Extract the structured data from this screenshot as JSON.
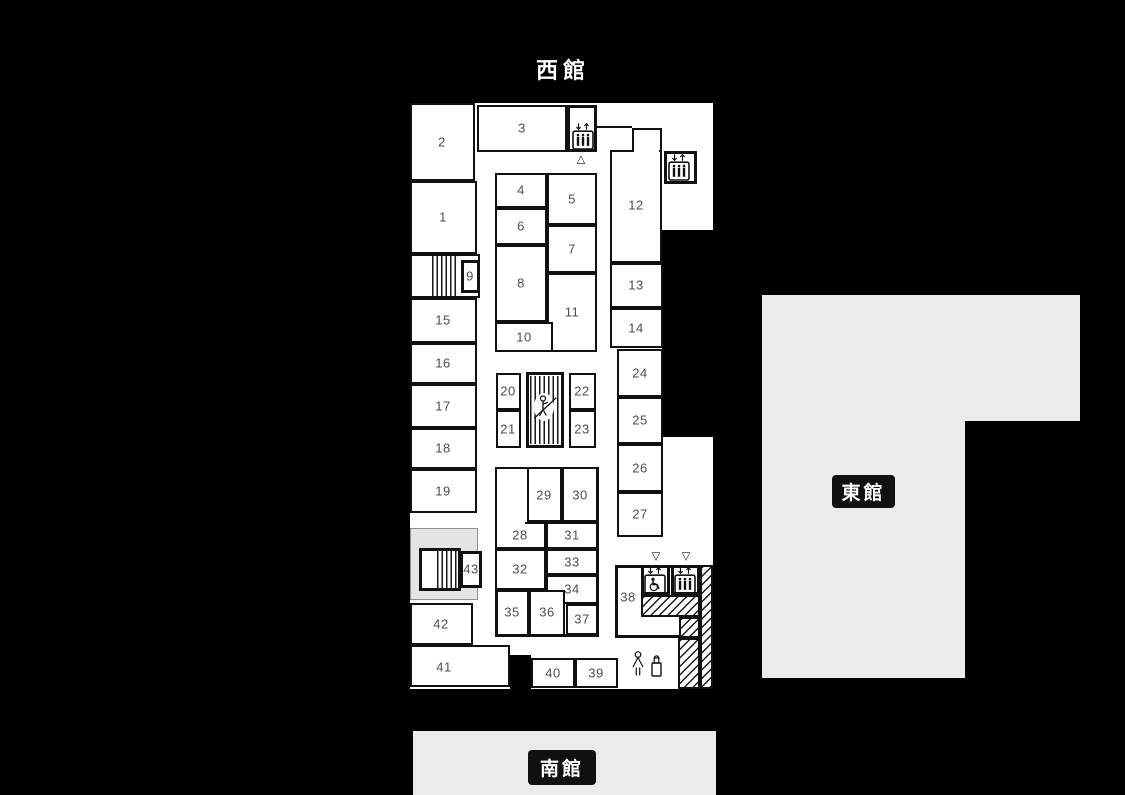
{
  "buildings": {
    "west": {
      "title": "西館"
    },
    "east": {
      "label": "東館"
    },
    "south": {
      "label": "南館"
    }
  },
  "palette": {
    "background": "#000000",
    "wall": "#111111",
    "room_fill": "#ffffff",
    "number_color": "#4d4d4d",
    "building_gray": "#ebebeb",
    "badge_bg": "#111111",
    "badge_text": "#ffffff"
  },
  "floorplan": {
    "base": {
      "x": 410,
      "y": 103,
      "w": 303,
      "h": 586
    },
    "boxes": [
      {
        "name": "room-2",
        "x": 410,
        "y": 103,
        "w": 65,
        "h": 78,
        "b": 2
      },
      {
        "name": "room-1",
        "x": 410,
        "y": 181,
        "w": 67,
        "h": 73,
        "b": 2
      },
      {
        "name": "stairs-box-north",
        "x": 410,
        "y": 254,
        "w": 70,
        "h": 44,
        "b": 2
      },
      {
        "name": "room-9",
        "x": 461,
        "y": 260,
        "w": 19,
        "h": 33,
        "b": 3
      },
      {
        "name": "room-15",
        "x": 410,
        "y": 298,
        "w": 67,
        "h": 45,
        "b": 2
      },
      {
        "name": "room-16",
        "x": 410,
        "y": 343,
        "w": 67,
        "h": 41,
        "b": 2
      },
      {
        "name": "room-17",
        "x": 410,
        "y": 384,
        "w": 67,
        "h": 44,
        "b": 2
      },
      {
        "name": "room-18",
        "x": 410,
        "y": 428,
        "w": 67,
        "h": 41,
        "b": 2
      },
      {
        "name": "room-19",
        "x": 410,
        "y": 469,
        "w": 67,
        "h": 44,
        "b": 2
      },
      {
        "name": "stairs-box-south",
        "x": 419,
        "y": 548,
        "w": 42,
        "h": 43,
        "b": 3
      },
      {
        "name": "room-43",
        "x": 460,
        "y": 551,
        "w": 22,
        "h": 37,
        "b": 3
      },
      {
        "name": "room-42",
        "x": 410,
        "y": 603,
        "w": 63,
        "h": 42,
        "b": 2
      },
      {
        "name": "room-41",
        "x": 410,
        "y": 645,
        "w": 100,
        "h": 42,
        "b": 2
      },
      {
        "name": "room-3",
        "x": 477,
        "y": 105,
        "w": 90,
        "h": 47,
        "b": 2
      },
      {
        "name": "elevator-box-north",
        "x": 567,
        "y": 105,
        "w": 30,
        "h": 47,
        "b": 3
      },
      {
        "name": "room-12-main",
        "x": 610,
        "y": 150,
        "w": 52,
        "h": 113,
        "b": 2
      },
      {
        "name": "room-12-top",
        "x": 632,
        "y": 128,
        "w": 30,
        "h": 24,
        "b": 2
      },
      {
        "name": "elevator-box-east",
        "x": 664,
        "y": 151,
        "w": 33,
        "h": 33,
        "b": 3
      },
      {
        "name": "room-13",
        "x": 610,
        "y": 263,
        "w": 53,
        "h": 45,
        "b": 2
      },
      {
        "name": "room-14",
        "x": 610,
        "y": 308,
        "w": 53,
        "h": 40,
        "b": 2
      },
      {
        "name": "block-4-11",
        "x": 495,
        "y": 173,
        "w": 102,
        "h": 179,
        "b": 3
      },
      {
        "name": "room-4",
        "x": 495,
        "y": 173,
        "w": 52,
        "h": 35,
        "b": 2
      },
      {
        "name": "room-5",
        "x": 547,
        "y": 173,
        "w": 50,
        "h": 52,
        "b": 2
      },
      {
        "name": "room-6",
        "x": 495,
        "y": 208,
        "w": 52,
        "h": 37,
        "b": 2
      },
      {
        "name": "room-7",
        "x": 547,
        "y": 225,
        "w": 50,
        "h": 48,
        "b": 2
      },
      {
        "name": "room-8",
        "x": 495,
        "y": 245,
        "w": 52,
        "h": 77,
        "b": 2
      },
      {
        "name": "room-11",
        "x": 547,
        "y": 273,
        "w": 50,
        "h": 79,
        "b": 2
      },
      {
        "name": "room-10",
        "x": 495,
        "y": 322,
        "w": 58,
        "h": 30,
        "b": 2
      },
      {
        "name": "block-20-21",
        "x": 496,
        "y": 373,
        "w": 25,
        "h": 75,
        "b": 3
      },
      {
        "name": "room-20",
        "x": 496,
        "y": 373,
        "w": 25,
        "h": 37,
        "b": 2
      },
      {
        "name": "room-21",
        "x": 496,
        "y": 410,
        "w": 25,
        "h": 38,
        "b": 2
      },
      {
        "name": "escalator-box",
        "x": 526,
        "y": 372,
        "w": 38,
        "h": 76,
        "b": 3
      },
      {
        "name": "block-22-23",
        "x": 569,
        "y": 373,
        "w": 27,
        "h": 75,
        "b": 3
      },
      {
        "name": "room-22",
        "x": 569,
        "y": 373,
        "w": 27,
        "h": 37,
        "b": 2
      },
      {
        "name": "room-23",
        "x": 569,
        "y": 410,
        "w": 27,
        "h": 38,
        "b": 2
      },
      {
        "name": "room-24",
        "x": 617,
        "y": 349,
        "w": 46,
        "h": 48,
        "b": 2
      },
      {
        "name": "room-25",
        "x": 617,
        "y": 397,
        "w": 46,
        "h": 47,
        "b": 2
      },
      {
        "name": "room-26",
        "x": 617,
        "y": 444,
        "w": 46,
        "h": 48,
        "b": 2
      },
      {
        "name": "room-27",
        "x": 617,
        "y": 492,
        "w": 46,
        "h": 45,
        "b": 2
      },
      {
        "name": "block-28-37",
        "x": 495,
        "y": 467,
        "w": 104,
        "h": 170,
        "b": 3
      },
      {
        "name": "room-28-upper",
        "x": 495,
        "y": 467,
        "w": 34,
        "h": 57,
        "b": 2
      },
      {
        "name": "room-29",
        "x": 527,
        "y": 467,
        "w": 35,
        "h": 55,
        "b": 2
      },
      {
        "name": "room-30",
        "x": 562,
        "y": 467,
        "w": 36,
        "h": 55,
        "b": 2
      },
      {
        "name": "room-28",
        "x": 495,
        "y": 522,
        "w": 51,
        "h": 27,
        "b": 2
      },
      {
        "name": "room-31",
        "x": 546,
        "y": 522,
        "w": 52,
        "h": 27,
        "b": 2
      },
      {
        "name": "room-32",
        "x": 495,
        "y": 549,
        "w": 51,
        "h": 41,
        "b": 2
      },
      {
        "name": "room-33",
        "x": 546,
        "y": 549,
        "w": 52,
        "h": 26,
        "b": 2
      },
      {
        "name": "room-34",
        "x": 546,
        "y": 575,
        "w": 52,
        "h": 29,
        "b": 2
      },
      {
        "name": "block-35-36",
        "x": 496,
        "y": 590,
        "w": 69,
        "h": 46,
        "b": 3
      },
      {
        "name": "room-35",
        "x": 496,
        "y": 590,
        "w": 33,
        "h": 46,
        "b": 2
      },
      {
        "name": "room-36",
        "x": 529,
        "y": 590,
        "w": 36,
        "h": 46,
        "b": 2
      },
      {
        "name": "room-37",
        "x": 566,
        "y": 604,
        "w": 32,
        "h": 31,
        "b": 2
      },
      {
        "name": "block-38",
        "x": 615,
        "y": 565,
        "w": 86,
        "h": 73,
        "b": 3
      },
      {
        "name": "elevator-box-wheelchair",
        "x": 641,
        "y": 565,
        "w": 29,
        "h": 30,
        "b": 3
      },
      {
        "name": "elevator-box-south",
        "x": 671,
        "y": 565,
        "w": 29,
        "h": 30,
        "b": 3
      },
      {
        "name": "room-40",
        "x": 531,
        "y": 658,
        "w": 44,
        "h": 30,
        "b": 2
      },
      {
        "name": "room-39",
        "x": 575,
        "y": 658,
        "w": 43,
        "h": 30,
        "b": 2
      }
    ],
    "labels": [
      {
        "t": "1",
        "x": 443,
        "y": 217
      },
      {
        "t": "2",
        "x": 442,
        "y": 142
      },
      {
        "t": "3",
        "x": 522,
        "y": 128
      },
      {
        "t": "4",
        "x": 521,
        "y": 190
      },
      {
        "t": "5",
        "x": 572,
        "y": 199
      },
      {
        "t": "6",
        "x": 521,
        "y": 226
      },
      {
        "t": "7",
        "x": 572,
        "y": 249
      },
      {
        "t": "8",
        "x": 521,
        "y": 283
      },
      {
        "t": "9",
        "x": 470,
        "y": 276
      },
      {
        "t": "10",
        "x": 524,
        "y": 337
      },
      {
        "t": "11",
        "x": 572,
        "y": 312
      },
      {
        "t": "12",
        "x": 636,
        "y": 205
      },
      {
        "t": "13",
        "x": 636,
        "y": 285
      },
      {
        "t": "14",
        "x": 636,
        "y": 328
      },
      {
        "t": "15",
        "x": 443,
        "y": 320
      },
      {
        "t": "16",
        "x": 443,
        "y": 363
      },
      {
        "t": "17",
        "x": 443,
        "y": 406
      },
      {
        "t": "18",
        "x": 443,
        "y": 448
      },
      {
        "t": "19",
        "x": 443,
        "y": 491
      },
      {
        "t": "20",
        "x": 508,
        "y": 391
      },
      {
        "t": "21",
        "x": 508,
        "y": 429
      },
      {
        "t": "22",
        "x": 582,
        "y": 391
      },
      {
        "t": "23",
        "x": 582,
        "y": 429
      },
      {
        "t": "24",
        "x": 640,
        "y": 373
      },
      {
        "t": "25",
        "x": 640,
        "y": 420
      },
      {
        "t": "26",
        "x": 640,
        "y": 468
      },
      {
        "t": "27",
        "x": 640,
        "y": 514
      },
      {
        "t": "28",
        "x": 520,
        "y": 535
      },
      {
        "t": "29",
        "x": 544,
        "y": 495
      },
      {
        "t": "30",
        "x": 580,
        "y": 495
      },
      {
        "t": "31",
        "x": 572,
        "y": 535
      },
      {
        "t": "32",
        "x": 520,
        "y": 569
      },
      {
        "t": "33",
        "x": 572,
        "y": 562
      },
      {
        "t": "34",
        "x": 572,
        "y": 589
      },
      {
        "t": "35",
        "x": 512,
        "y": 612
      },
      {
        "t": "36",
        "x": 547,
        "y": 612
      },
      {
        "t": "37",
        "x": 582,
        "y": 619
      },
      {
        "t": "38",
        "x": 628,
        "y": 597
      },
      {
        "t": "39",
        "x": 596,
        "y": 673
      },
      {
        "t": "40",
        "x": 553,
        "y": 673
      },
      {
        "t": "41",
        "x": 444,
        "y": 667
      },
      {
        "t": "42",
        "x": 441,
        "y": 624
      },
      {
        "t": "43",
        "x": 471,
        "y": 569
      }
    ],
    "black_notches": [
      {
        "x": 662,
        "y": 230,
        "w": 51,
        "h": 207
      },
      {
        "x": 510,
        "y": 655,
        "w": 21,
        "h": 34
      }
    ],
    "gray_areas": [
      {
        "x": 410,
        "y": 528,
        "w": 68,
        "h": 72
      }
    ],
    "patches": [
      {
        "x": 634,
        "y": 149,
        "w": 25,
        "h": 5
      },
      {
        "x": 497,
        "y": 521,
        "w": 28,
        "h": 5
      }
    ],
    "walls": [
      {
        "x": 595,
        "y": 126,
        "w": 37,
        "h": 2
      }
    ],
    "stairs": [
      {
        "x": 432,
        "y": 256,
        "w": 27,
        "h": 40
      },
      {
        "x": 437,
        "y": 550,
        "w": 22,
        "h": 39
      },
      {
        "x": 530,
        "y": 376,
        "w": 30,
        "h": 68
      }
    ],
    "hatched": [
      {
        "x": 641,
        "y": 595,
        "w": 59,
        "h": 22
      },
      {
        "x": 679,
        "y": 617,
        "w": 21,
        "h": 21
      },
      {
        "x": 700,
        "y": 565,
        "w": 13,
        "h": 124
      },
      {
        "x": 678,
        "y": 638,
        "w": 22,
        "h": 51
      }
    ],
    "markers": [
      {
        "glyph": "△",
        "name": "entrance-triangle-up",
        "x": 581,
        "y": 160
      },
      {
        "glyph": "▽",
        "name": "entrance-triangle-down",
        "x": 656,
        "y": 557
      },
      {
        "glyph": "▽",
        "name": "entrance-triangle-down",
        "x": 686,
        "y": 557
      }
    ],
    "icons": [
      {
        "type": "elevator-people",
        "name": "elevator-icon",
        "x": 572,
        "y": 123
      },
      {
        "type": "elevator-people",
        "name": "elevator-icon",
        "x": 668,
        "y": 154
      },
      {
        "type": "elevator-wheelchair",
        "name": "accessible-elevator-icon",
        "x": 644,
        "y": 567
      },
      {
        "type": "elevator-people",
        "name": "elevator-icon",
        "x": 674,
        "y": 567
      },
      {
        "type": "escalator-person",
        "name": "escalator-icon",
        "x": 533,
        "y": 391
      },
      {
        "type": "person",
        "name": "person-icon",
        "x": 630,
        "y": 650
      },
      {
        "type": "extinguisher",
        "name": "fire-extinguisher-icon",
        "x": 649,
        "y": 653
      }
    ],
    "east_shape": [
      {
        "x": 762,
        "y": 295,
        "w": 318,
        "h": 126
      },
      {
        "x": 762,
        "y": 295,
        "w": 203,
        "h": 383
      }
    ],
    "south_shape": [
      {
        "x": 413,
        "y": 731,
        "w": 303,
        "h": 64
      }
    ]
  }
}
